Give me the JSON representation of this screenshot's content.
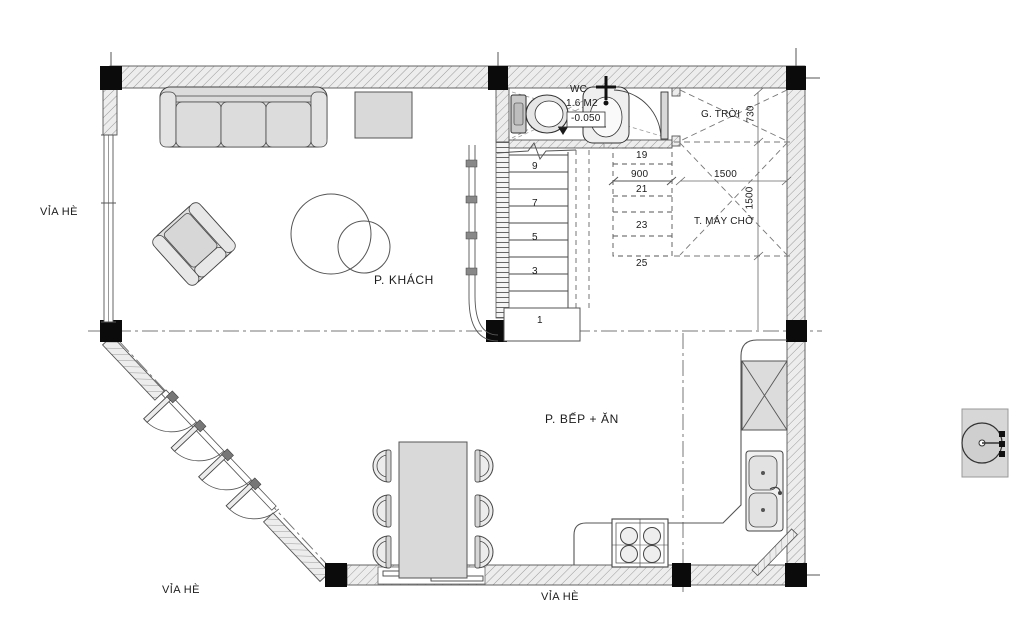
{
  "title": "Ground floor plan",
  "labels": {
    "via_he_left": "VỈA HÈ",
    "via_he_bottom_left": "VỈA HÈ",
    "via_he_bottom": "VỈA HÈ",
    "living_room": "P. KHÁCH",
    "kitchen_dining": "P. BẾP + ĂN",
    "skylight": "G. TRỜI",
    "elevator_shaft": "T. MÁY CHỜ",
    "wc_title": "WC",
    "wc_area": "1.6 M2",
    "wc_level": "-0.050"
  },
  "stairs": {
    "tread_1": "1",
    "tread_3": "3",
    "tread_5": "5",
    "tread_7": "7",
    "tread_9": "9",
    "tread_19": "19",
    "tread_21": "21",
    "tread_23": "23",
    "tread_25": "25"
  },
  "dimensions": {
    "stair_width": "900",
    "skylight_depth": "730",
    "shaft_width": "1500",
    "shaft_depth": "1500"
  },
  "colors": {
    "wall_hatch_line": "#9a9a9a",
    "wall_fill": "#ededed",
    "column": "#0b0b0b",
    "linework": "#4a4a4a",
    "furniture_fill": "#dcdcdc",
    "grid_dashdot": "#777777"
  }
}
